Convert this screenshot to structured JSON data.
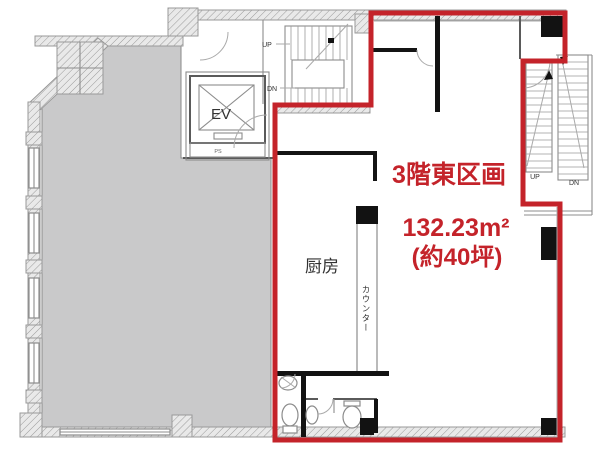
{
  "plan": {
    "section_label": "3階東区画",
    "area_sqm": "132.23m²",
    "area_tsubo": "(約40坪)",
    "rooms": {
      "kitchen": "厨房",
      "counter": "カウンター",
      "elevator": "EV",
      "pipe_space": "PS"
    },
    "stairs_center": {
      "up": "UP",
      "down": "DN"
    },
    "stairs_east": {
      "up": "UP",
      "down": "DN"
    }
  },
  "colors": {
    "outline_red": "#c4232a",
    "neighbor_unit_gray": "#c9c9ca"
  }
}
